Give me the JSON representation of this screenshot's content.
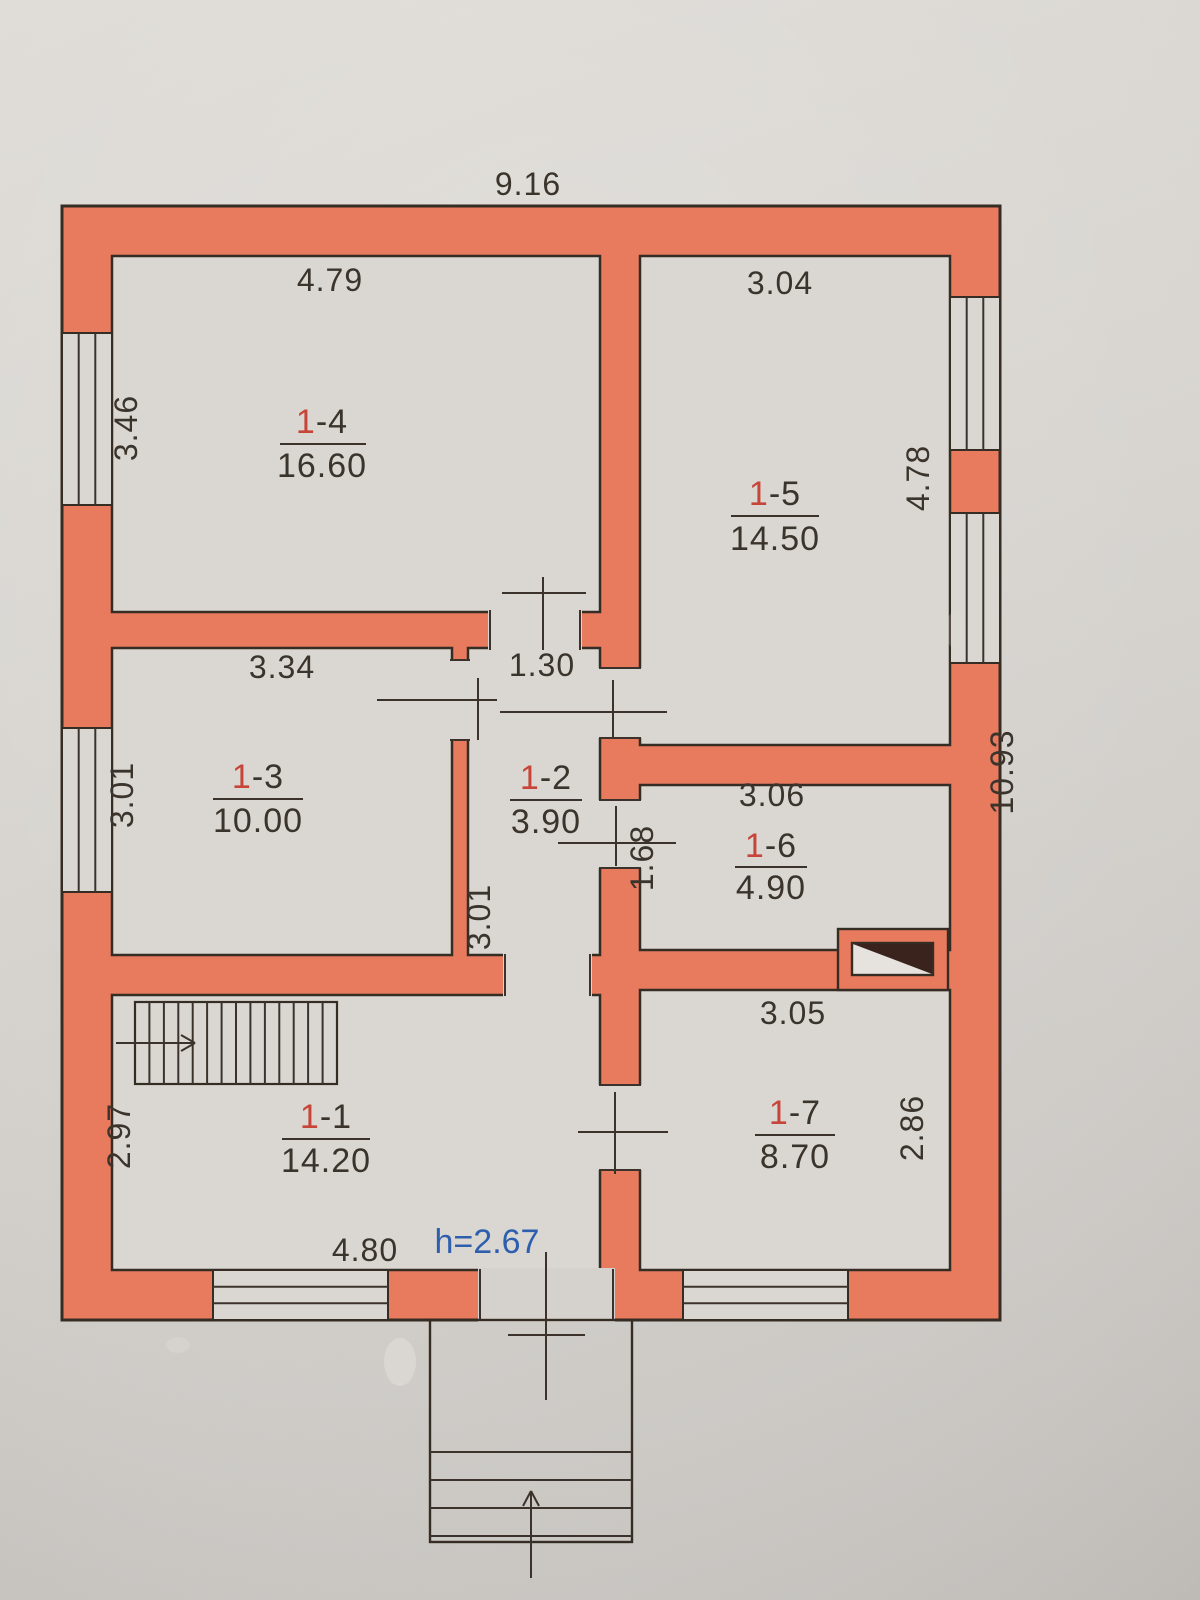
{
  "plan": {
    "building": {
      "total_width": "9.16",
      "total_height": "10.93",
      "ceiling_height": "h=2.67"
    },
    "rooms": {
      "r11": {
        "prefix": "1",
        "suffix": "-1",
        "area": "14.20"
      },
      "r12": {
        "prefix": "1",
        "suffix": "-2",
        "area": "3.90"
      },
      "r13": {
        "prefix": "1",
        "suffix": "-3",
        "area": "10.00"
      },
      "r14": {
        "prefix": "1",
        "suffix": "-4",
        "area": "16.60"
      },
      "r15": {
        "prefix": "1",
        "suffix": "-5",
        "area": "14.50"
      },
      "r16": {
        "prefix": "1",
        "suffix": "-6",
        "area": "4.90"
      },
      "r17": {
        "prefix": "1",
        "suffix": "-7",
        "area": "8.70"
      }
    },
    "dims": {
      "top_total": "9.16",
      "right_total": "10.93",
      "r14_top": "4.79",
      "r14_left": "3.46",
      "r15_top": "3.04",
      "r15_right": "4.78",
      "r13_top": "3.34",
      "r13_left": "3.01",
      "r12_top": "1.30",
      "r12_left": "3.01",
      "r16_top": "3.06",
      "r16_left": "1.68",
      "r17_top": "3.05",
      "r17_right": "2.86",
      "r11_left": "2.97",
      "r11_bottom": "4.80",
      "ceiling_height": "h=2.67"
    },
    "colors": {
      "wall": "#e87a5e",
      "outline": "#352c24",
      "floor": "#dad7d2",
      "paper": "#d2cfca",
      "room_number_red": "#c74538",
      "height_blue": "#2d5fae",
      "ink": "#3b342d",
      "vent_dark": "#3a231c"
    }
  }
}
